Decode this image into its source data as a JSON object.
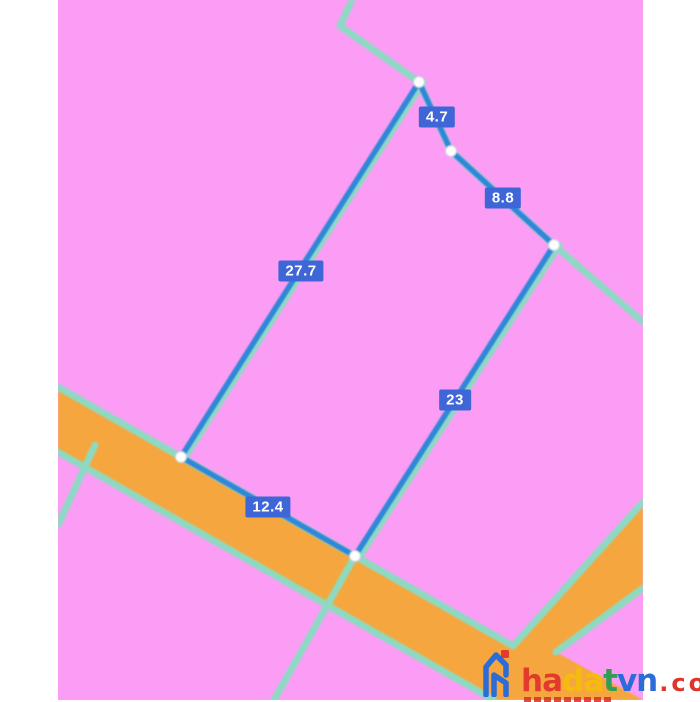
{
  "map": {
    "colors": {
      "parcel_fill": "#fb9df4",
      "road_fill": "#f6a63e",
      "boundary_line": "#8adcc3",
      "measure_line": "#2e87d8",
      "measure_label_bg": "#3f66d6",
      "measure_label_text": "#ffffff",
      "vertex_dot": "#ffffff",
      "page_margin": "#ffffff"
    },
    "measurements": {
      "top": "4.7",
      "upper_right": "8.8",
      "left_side": "27.7",
      "right_side": "23",
      "bottom": "12.4"
    }
  },
  "watermark": {
    "segments": [
      {
        "text": "ha",
        "color": "#e23a2c"
      },
      {
        "text": "da",
        "color": "#f5bb0f"
      },
      {
        "text": "t",
        "color": "#2f9e50"
      },
      {
        "text": "vn",
        "color": "#2c6cd9"
      }
    ],
    "suffix": {
      "text": ".com.vn",
      "color": "#e0342b"
    }
  }
}
